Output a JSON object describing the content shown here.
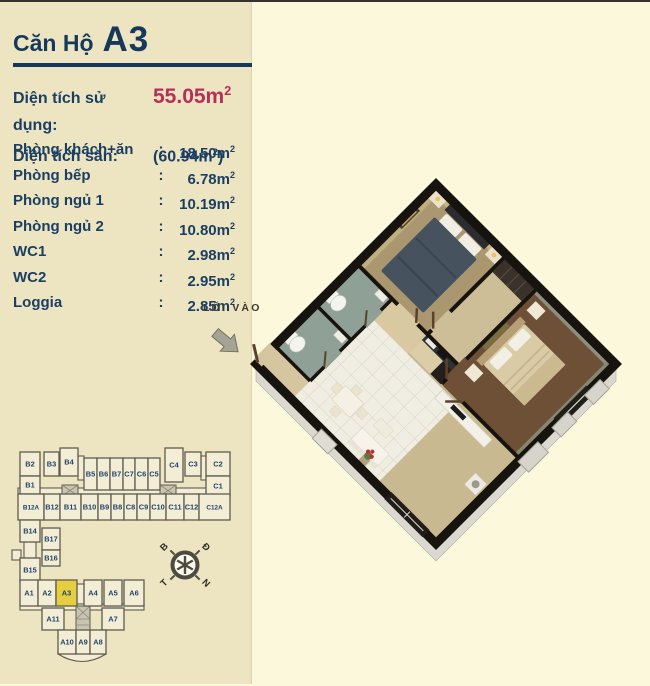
{
  "header": {
    "title_prefix": "Căn Hộ",
    "title_unit": "A3"
  },
  "areas": {
    "usable": {
      "label": "Diện tích sử dụng:",
      "value": "55.05m",
      "sup": "2"
    },
    "floor": {
      "label": "Diện tích sàn:",
      "value": "(60.94m",
      "sup": "2",
      "suffix": ")"
    },
    "colon": ":"
  },
  "rooms": [
    {
      "label": "Phòng khách+ăn",
      "colon": ":",
      "value": "18.50m",
      "sup": "2"
    },
    {
      "label": "Phòng bếp",
      "colon": ":",
      "value": "6.78m",
      "sup": "2"
    },
    {
      "label": "Phòng ngủ 1",
      "colon": ":",
      "value": "10.19m",
      "sup": "2"
    },
    {
      "label": "Phòng ngủ 2",
      "colon": ":",
      "value": "10.80m",
      "sup": "2"
    },
    {
      "label": "WC1",
      "colon": ":",
      "value": "2.98m",
      "sup": "2"
    },
    {
      "label": "WC2",
      "colon": ":",
      "value": "2.95m",
      "sup": "2"
    },
    {
      "label": "Loggia",
      "colon": ":",
      "value": "2.85m",
      "sup": "2"
    }
  ],
  "entrance_label": "LỐI VÀO",
  "compass": {
    "n": "B",
    "e": "Đ",
    "w": "T",
    "s": "N"
  },
  "site_map": {
    "highlighted_unit": "A3",
    "units": [
      {
        "label": "B2",
        "x": 20,
        "y": 450,
        "w": 20,
        "h": 24
      },
      {
        "label": "B3",
        "x": 44,
        "y": 450,
        "w": 15,
        "h": 24
      },
      {
        "label": "B4",
        "x": 60,
        "y": 446,
        "w": 18,
        "h": 28
      },
      {
        "label": "B5",
        "x": 84,
        "y": 456,
        "w": 13,
        "h": 32
      },
      {
        "label": "B6",
        "x": 97,
        "y": 456,
        "w": 13,
        "h": 32
      },
      {
        "label": "B7",
        "x": 110,
        "y": 456,
        "w": 13,
        "h": 32
      },
      {
        "label": "C7",
        "x": 123,
        "y": 456,
        "w": 12,
        "h": 32
      },
      {
        "label": "C6",
        "x": 135,
        "y": 456,
        "w": 13,
        "h": 32
      },
      {
        "label": "C5",
        "x": 148,
        "y": 456,
        "w": 12,
        "h": 32
      },
      {
        "label": "C4",
        "x": 165,
        "y": 446,
        "w": 18,
        "h": 34
      },
      {
        "label": "C3",
        "x": 185,
        "y": 450,
        "w": 16,
        "h": 24
      },
      {
        "label": "C2",
        "x": 206,
        "y": 450,
        "w": 24,
        "h": 24
      },
      {
        "label": "B1",
        "x": 20,
        "y": 474,
        "w": 20,
        "h": 18
      },
      {
        "label": "C1",
        "x": 206,
        "y": 474,
        "w": 24,
        "h": 20
      },
      {
        "label": "B12A",
        "x": 18,
        "y": 492,
        "w": 26,
        "h": 26
      },
      {
        "label": "B12",
        "x": 44,
        "y": 492,
        "w": 16,
        "h": 26
      },
      {
        "label": "B11",
        "x": 60,
        "y": 492,
        "w": 21,
        "h": 26
      },
      {
        "label": "B10",
        "x": 81,
        "y": 492,
        "w": 17,
        "h": 26
      },
      {
        "label": "B9",
        "x": 98,
        "y": 492,
        "w": 13,
        "h": 26
      },
      {
        "label": "B8",
        "x": 111,
        "y": 492,
        "w": 13,
        "h": 26
      },
      {
        "label": "C8",
        "x": 124,
        "y": 492,
        "w": 13,
        "h": 26
      },
      {
        "label": "C9",
        "x": 137,
        "y": 492,
        "w": 13,
        "h": 26
      },
      {
        "label": "C10",
        "x": 150,
        "y": 492,
        "w": 16,
        "h": 26
      },
      {
        "label": "C11",
        "x": 166,
        "y": 492,
        "w": 18,
        "h": 26
      },
      {
        "label": "C12",
        "x": 184,
        "y": 492,
        "w": 15,
        "h": 26
      },
      {
        "label": "C12A",
        "x": 199,
        "y": 492,
        "w": 31,
        "h": 26
      },
      {
        "label": "B14",
        "x": 20,
        "y": 518,
        "w": 20,
        "h": 22
      },
      {
        "label": "B17",
        "x": 42,
        "y": 526,
        "w": 18,
        "h": 22
      },
      {
        "label": "B16",
        "x": 42,
        "y": 548,
        "w": 18,
        "h": 16
      },
      {
        "label": "B15",
        "x": 20,
        "y": 556,
        "w": 20,
        "h": 24
      },
      {
        "label": "A1",
        "x": 20,
        "y": 578,
        "w": 18,
        "h": 26
      },
      {
        "label": "A2",
        "x": 38,
        "y": 578,
        "w": 18,
        "h": 26
      },
      {
        "label": "A3",
        "x": 56,
        "y": 578,
        "w": 21,
        "h": 26,
        "hl": true
      },
      {
        "label": "A4",
        "x": 84,
        "y": 578,
        "w": 18,
        "h": 26
      },
      {
        "label": "A5",
        "x": 104,
        "y": 578,
        "w": 18,
        "h": 26
      },
      {
        "label": "A6",
        "x": 124,
        "y": 578,
        "w": 20,
        "h": 26
      },
      {
        "label": "A11",
        "x": 42,
        "y": 606,
        "w": 22,
        "h": 22
      },
      {
        "label": "A7",
        "x": 102,
        "y": 606,
        "w": 22,
        "h": 22
      },
      {
        "label": "A10",
        "x": 58,
        "y": 628,
        "w": 18,
        "h": 24
      },
      {
        "label": "A9",
        "x": 76,
        "y": 628,
        "w": 14,
        "h": 24
      },
      {
        "label": "A8",
        "x": 90,
        "y": 628,
        "w": 16,
        "h": 24
      }
    ]
  },
  "colors": {
    "page_bg": "#FCF8DB",
    "sidebar_bg": "#EDE4C2",
    "accent_navy": "#16395B",
    "value_crimson": "#B72F58",
    "highlight_yellow": "#E5CE3F",
    "map_fill": "#F4EDD6",
    "map_line": "#5E5C4E",
    "map_label": "#1E4467"
  }
}
